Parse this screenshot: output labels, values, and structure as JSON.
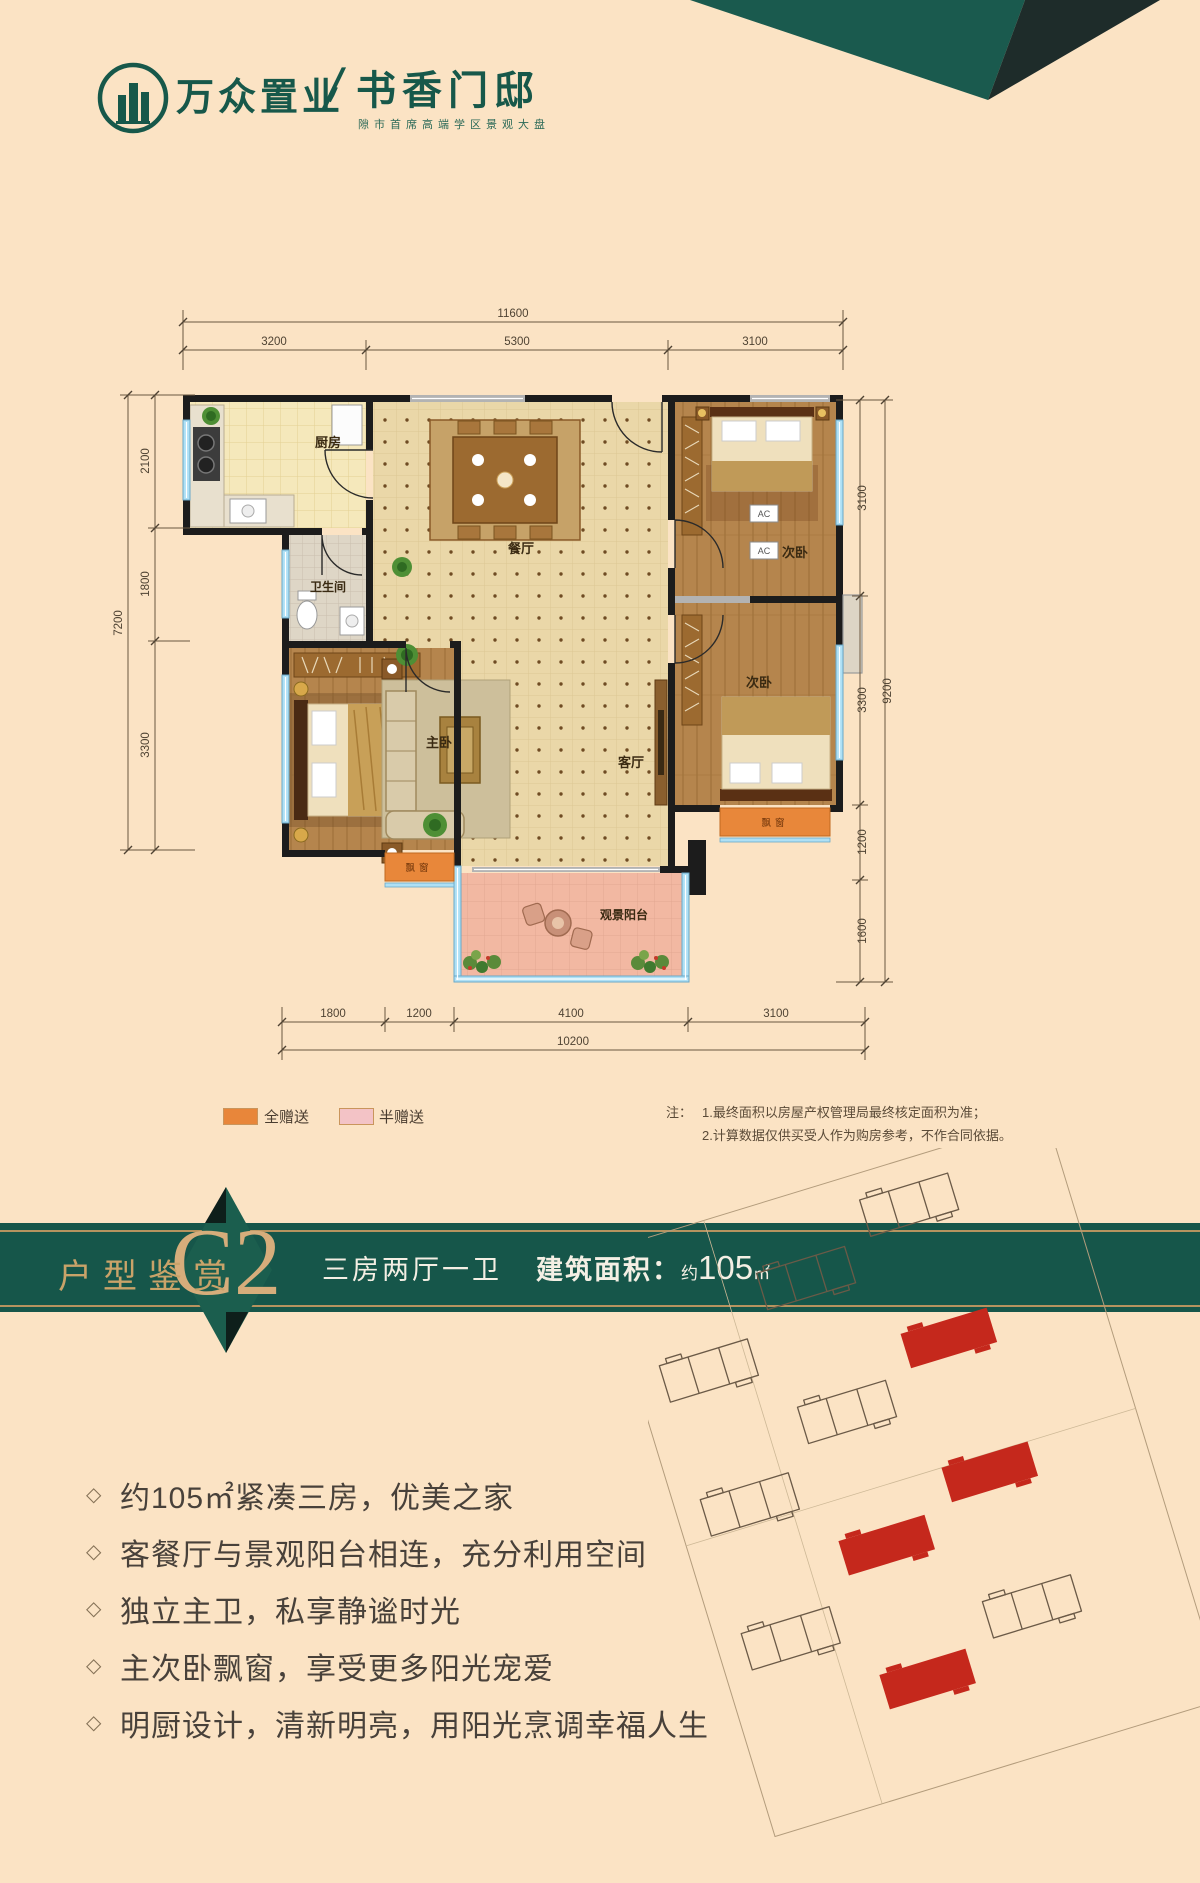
{
  "logo": {
    "brand": "万众置业",
    "divider": "/",
    "project": "书香门邸",
    "subtitle": "隙市首席高端学区景观大盘"
  },
  "floor_plan": {
    "dims": {
      "top": [
        "11600",
        "3200",
        "5300",
        "3100"
      ],
      "left": [
        "7200",
        "2100",
        "1800",
        "3300"
      ],
      "right": [
        "9200",
        "3100",
        "3300",
        "1200",
        "1600"
      ],
      "bottom": [
        "1800",
        "1200",
        "4100",
        "3100",
        "10200"
      ]
    },
    "rooms": {
      "kitchen": "厨房",
      "dining": "餐厅",
      "bathroom": "卫生间",
      "master": "主卧",
      "living": "客厅",
      "bedroom": "次卧",
      "balcony": "观景阳台",
      "bay_window": "飘窗",
      "ac": "AC"
    },
    "legend": [
      {
        "label": "全赠送",
        "color": "#e8863a"
      },
      {
        "label": "半赠送",
        "color": "#f3c3c6"
      }
    ],
    "note": {
      "label": "注：",
      "line1": "1.最终面积以房屋产权管理局最终核定面积为准；",
      "line2": "2.计算数据仅供买受人作为购房参考，不作合同依据。"
    }
  },
  "banner": {
    "section_title": "户型鉴赏",
    "unit": "C2",
    "layout": "三房两厅一卫",
    "area_label": "建筑面积：",
    "area_prefix": "约",
    "area_value": "105",
    "area_unit": "㎡",
    "band_color": "#16564a",
    "gold_color": "#b6935f"
  },
  "features": [
    "约105㎡紧凑三房，优美之家",
    "客餐厅与景观阳台相连，充分利用空间",
    "独立主卫，私享静谧时光",
    "主次卧飘窗，享受更多阳光宠爱",
    "明厨设计，清新明亮，用阳光烹调幸福人生"
  ],
  "features_bullet": "◇",
  "site_plan": {
    "highlight_color": "#c5281c"
  }
}
